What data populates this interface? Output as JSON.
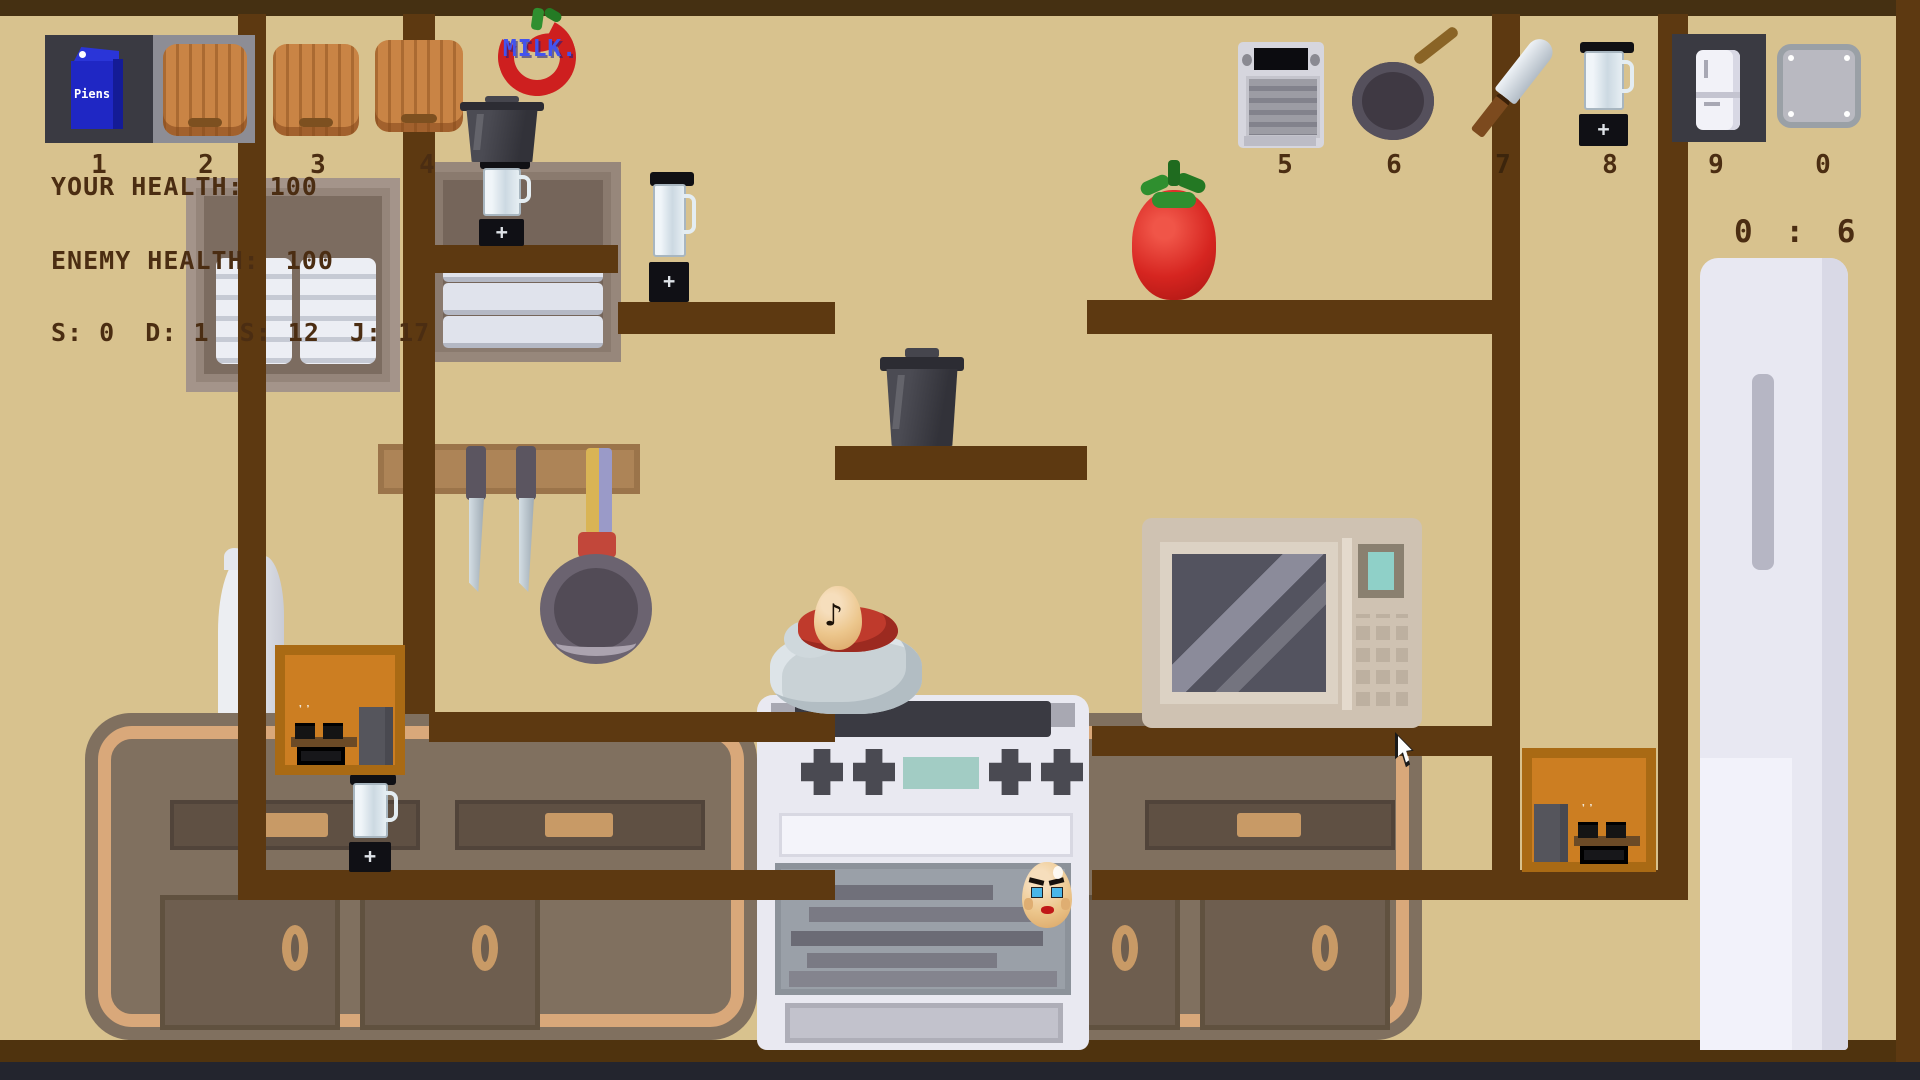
{
  "logo": {
    "text": "MILK."
  },
  "hud": {
    "your_health": {
      "label": "YOUR HEALTH:",
      "value": "100"
    },
    "enemy_health": {
      "label": "ENEMY HEALTH:",
      "value": "100"
    },
    "stats": [
      {
        "key": "S:",
        "value": "0"
      },
      {
        "key": "D:",
        "value": "1"
      },
      {
        "key": "S:",
        "value": "12"
      },
      {
        "key": "J:",
        "value": "17"
      }
    ],
    "timer": {
      "minutes": "0",
      "separator": ":",
      "seconds": "6"
    }
  },
  "hotbar": {
    "slots": [
      {
        "number": "1",
        "item": "milk-carton",
        "item_label": "Piens"
      },
      {
        "number": "2",
        "item": "cutting-board"
      },
      {
        "number": "3",
        "item": "cutting-board"
      },
      {
        "number": "4",
        "item": "cutting-board"
      },
      {
        "number": "5",
        "item": "toaster-oven"
      },
      {
        "number": "6",
        "item": "frying-pan"
      },
      {
        "number": "7",
        "item": "cleaver"
      },
      {
        "number": "8",
        "item": "blender"
      },
      {
        "number": "9",
        "item": "refrigerator"
      },
      {
        "number": "0",
        "item": "tray"
      }
    ]
  },
  "colors": {
    "background": "#d8c28e",
    "platform": "#5d3911",
    "hud_text": "#4b2d12",
    "logo_blue": "#4353ee",
    "carton_blue": "#1f27c4",
    "tomato_red": "#d62520",
    "orange_box": "#cc7e22"
  }
}
